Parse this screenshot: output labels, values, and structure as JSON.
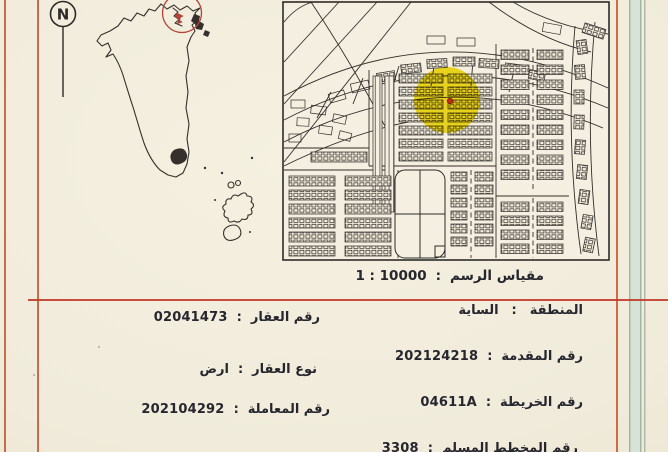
{
  "colors": {
    "accent_orange": "#c8552b",
    "separator_red": "#c23b2c",
    "band_green": "#d7e3d6",
    "band_green_edge": "#9db8a2",
    "highlight_yellow": "#f2e01f",
    "marker_red": "#c0251d",
    "map_line": "#2e2a28",
    "locator_circle_red": "#b5423a",
    "paper": "#f0ebda"
  },
  "punct": {
    "colon": ":"
  },
  "compass": {
    "letter": "N"
  },
  "scale": {
    "label": "مقياس الرسم",
    "value": "1 : 10000"
  },
  "fields": {
    "right": [
      {
        "label": "المنطقة",
        "value": "الساية"
      },
      {
        "label": "رقم المقدمة",
        "value": "202124218"
      },
      {
        "label": "رقم الخريطة",
        "value": "04611A"
      },
      {
        "label": "رقم المخطط المسلم",
        "value": "3308"
      }
    ],
    "left": [
      {
        "label": "رقم العقار",
        "value": "02041473"
      },
      {
        "label": "نوع العقار",
        "value": "ارض"
      },
      {
        "label": "رقم المعاملة",
        "value": "202104292"
      }
    ]
  }
}
